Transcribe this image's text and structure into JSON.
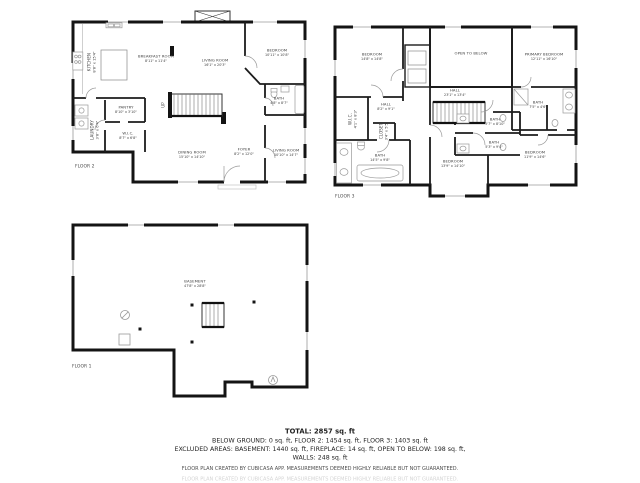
{
  "page": {
    "background": "#ffffff",
    "wall_color": "#141414"
  },
  "floor2": {
    "tag": "FLOOR 2",
    "rooms": {
      "kitchen": {
        "name": "KITCHEN",
        "dims": "8'8\" x 15'4\""
      },
      "breakfast": {
        "name": "BREAKFAST ROOM",
        "dims": "8'11\" x 11'4\""
      },
      "living_main": {
        "name": "LIVING ROOM",
        "dims": "16'1\" x 20'3\""
      },
      "bedroom": {
        "name": "BEDROOM",
        "dims": "10'11\" x 10'8\""
      },
      "bath": {
        "name": "BATH",
        "dims": "4'8\" x 8'7\""
      },
      "pantry": {
        "name": "PANTRY",
        "dims": "8'10\" x 3'10\""
      },
      "wic": {
        "name": "W.I.C.",
        "dims": "8'7\" x 6'8\""
      },
      "laundry": {
        "name": "LAUNDRY",
        "dims": "3'8\" x 6'4\""
      },
      "stairs": {
        "name": "UP"
      },
      "dining": {
        "name": "DINING ROOM",
        "dims": "15'10\" x 14'10\""
      },
      "foyer": {
        "name": "FOYER",
        "dims": "8'2\" x 12'0\""
      },
      "living_small": {
        "name": "LIVING ROOM",
        "dims": "10'10\" x 14'7\""
      }
    }
  },
  "floor3": {
    "tag": "FLOOR 3",
    "rooms": {
      "bedroom_tl": {
        "name": "BEDROOM",
        "dims": "14'8\" x 14'8\""
      },
      "open_below": {
        "name": "OPEN TO BELOW"
      },
      "primary": {
        "name": "PRIMARY BEDROOM",
        "dims": "12'11\" x 16'10\""
      },
      "hall_main": {
        "name": "HALL",
        "dims": "23'1\" x 13'4\""
      },
      "hall_left": {
        "name": "HALL",
        "dims": "8'2\" x 9'1\""
      },
      "wic_left": {
        "name": "W.I.C.",
        "dims": "4'1\" x 8'3\""
      },
      "closet_small": {
        "name": "CLOSET",
        "dims": "3'4\" x 5'5\""
      },
      "bath_left": {
        "name": "BATH",
        "dims": "14'5\" x 9'8\""
      },
      "bath_mid_upper": {
        "name": "BATH",
        "dims": "5'7\" x 8'10\""
      },
      "bath_mid_lower": {
        "name": "BATH",
        "dims": "5'3\" x 9'4\""
      },
      "bath_primary": {
        "name": "BATH",
        "dims": "7'5\" x 4'6\""
      },
      "bedroom_bm": {
        "name": "BEDROOM",
        "dims": "13'9\" x 14'10\""
      },
      "bedroom_br": {
        "name": "BEDROOM",
        "dims": "11'9\" x 14'6\""
      }
    }
  },
  "floor1": {
    "tag": "FLOOR 1",
    "rooms": {
      "basement": {
        "name": "BASEMENT",
        "dims": "47'8\" x 28'8\""
      }
    }
  },
  "footer": {
    "total": "TOTAL: 2857 sq. ft",
    "line1": "BELOW GROUND: 0 sq. ft, FLOOR 2: 1454 sq. ft, FLOOR 3: 1403 sq. ft",
    "line2": "EXCLUDED AREAS: BASEMENT: 1440 sq. ft, FIREPLACE: 14 sq. ft, OPEN TO BELOW: 198 sq. ft,",
    "line3": "WALLS: 248 sq. ft",
    "disclaimer": "FLOOR PLAN CREATED BY CUBICASA APP. MEASUREMENTS DEEMED HIGHLY RELIABLE BUT NOT GUARANTEED.",
    "faint_line": "FLOOR PLAN CREATED BY CUBICASA APP. MEASUREMENTS DEEMED HIGHLY RELIABLE BUT NOT GUARANTEED."
  }
}
